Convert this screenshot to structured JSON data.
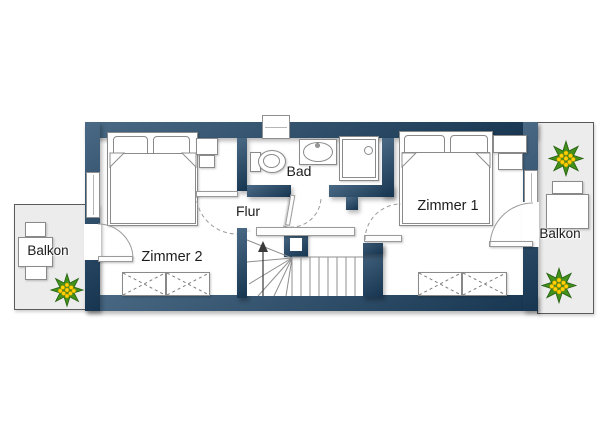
{
  "floorplan": {
    "rooms": {
      "zimmer1": {
        "label": "Zimmer 1"
      },
      "zimmer2": {
        "label": "Zimmer 2"
      },
      "bad": {
        "label": "Bad"
      },
      "flur": {
        "label": "Flur"
      },
      "balkon_left": {
        "label": "Balkon"
      },
      "balkon_right": {
        "label": "Balkon"
      }
    },
    "colors": {
      "wall": "#1d4466",
      "balcony_fill": "#ececec",
      "outline": "#8a8a8a",
      "plant_leaf": "#43911c",
      "plant_leaf_dark": "#276310",
      "plant_berry": "#ffd400",
      "label_text": "#1c1c1c"
    },
    "symbols": {
      "stairs": "stairs-up-arrow",
      "plants": "potted-plant",
      "beds": "double-bed",
      "wardrobes": "wardrobe-crossed-box",
      "bath_fixtures": [
        "toilet",
        "sink",
        "shower"
      ]
    }
  }
}
